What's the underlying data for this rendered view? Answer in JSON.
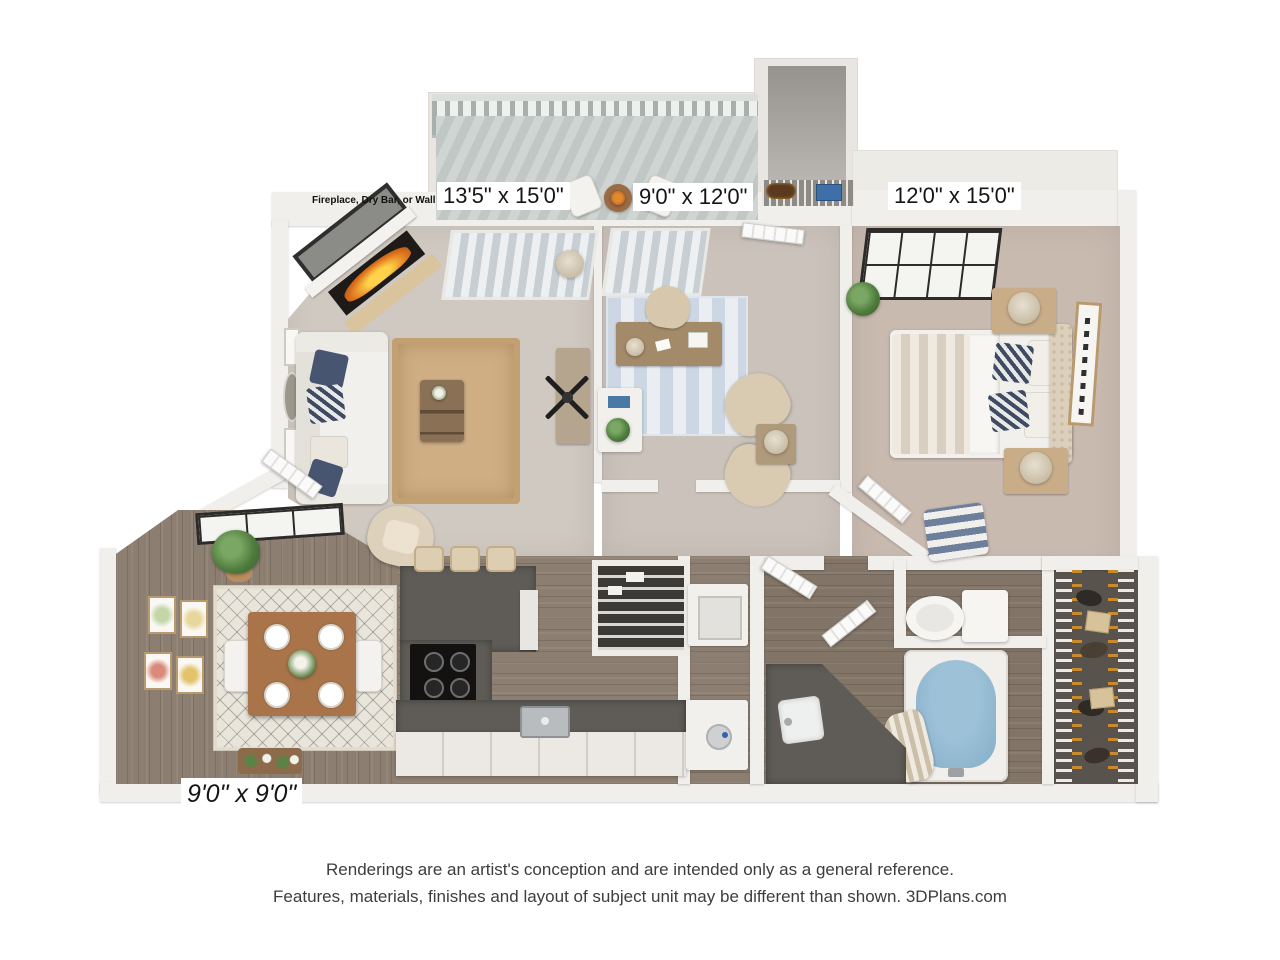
{
  "labels": {
    "fireplace_note": "Fireplace, Dry Bar, or Wall",
    "living_room": "13'5\" x 15'0\"",
    "bedroom2": "9'0\" x 12'0\"",
    "master_bedroom": "12'0\" x 15'0\"",
    "dining_area": "9'0\" x 9'0\""
  },
  "footer": {
    "line1": "Renderings are an artist's conception and are intended only as a general reference.",
    "line2": "Features, materials, finishes and layout of subject unit may be different than shown. 3DPlans.com"
  },
  "colors": {
    "wall": "#e9e6e1",
    "carpet_living": "#d0c9c1",
    "carpet_office": "#cbc3bb",
    "carpet_bedroom": "#c9bab0",
    "wood_floor": "#8c7e70",
    "balcony_deck": "#c7cdca",
    "kitchen_counter": "#5f5c57",
    "jute_rug": "#cfae84",
    "office_rug": "#ccd7e3",
    "bathtub_water": "#84adc8",
    "closet_floor": "#59534d",
    "fireplace_fire": "#e0761f",
    "pillow_navy": "#475571"
  }
}
